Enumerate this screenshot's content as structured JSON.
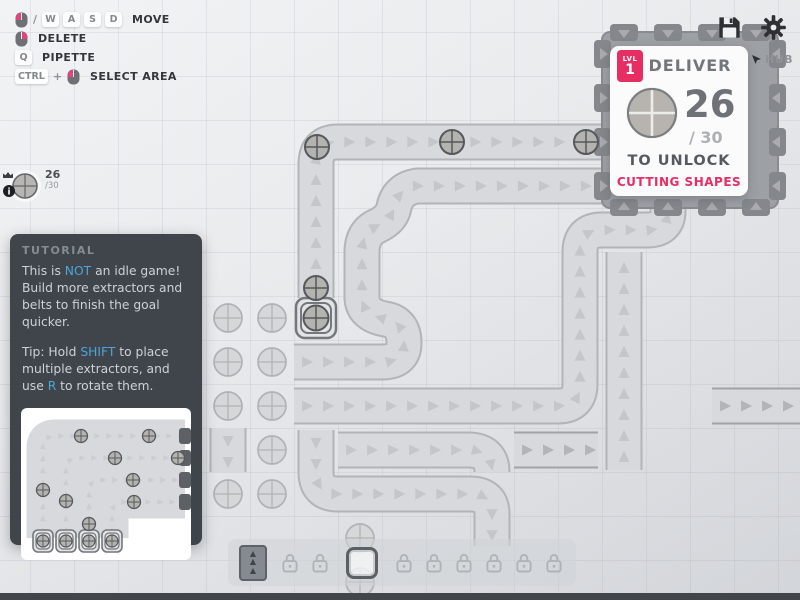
{
  "colors": {
    "accent": "#e62e63",
    "link": "#4da5d8"
  },
  "keybinds": {
    "slash": "/",
    "plus": "+",
    "row1": {
      "k1": "W",
      "k2": "A",
      "k3": "S",
      "k4": "D",
      "label": "MOVE",
      "icon": "mouse-left-click-icon"
    },
    "row2": {
      "label": "DELETE",
      "icon": "mouse-right-click-icon"
    },
    "row3": {
      "k1": "Q",
      "label": "PIPETTE"
    },
    "row4": {
      "k1": "CTRL",
      "label": "SELECT AREA",
      "icon": "mouse-left-click-icon"
    }
  },
  "pinned_goal": {
    "current": "26",
    "goal": "/30",
    "shape": "circle",
    "icons": [
      "crown-icon",
      "info-icon"
    ]
  },
  "tutorial": {
    "title": "TUTORIAL",
    "p1": [
      {
        "t": "This is "
      },
      {
        "t": "NOT",
        "hl": true
      },
      {
        "t": " an idle game! Build more extractors and belts to finish the goal quicker."
      }
    ],
    "p2": [
      {
        "t": "Tip: Hold "
      },
      {
        "t": "SHIFT",
        "hl": true
      },
      {
        "t": " to place multiple extractors, and use "
      },
      {
        "t": "R",
        "hl": true
      },
      {
        "t": " to rotate them."
      }
    ]
  },
  "hud": {
    "level_label": "LVL",
    "level": "1",
    "title": "DELIVER",
    "hub_label": "HUB",
    "current": "26",
    "goal": "/ 30",
    "unlock": "TO UNLOCK",
    "reward": "CUTTING SHAPES",
    "shape": "circle"
  },
  "top_icons": [
    "save-icon",
    "gear-icon"
  ],
  "toolbar": {
    "slots": [
      {
        "type": "belt",
        "selected": false
      },
      {
        "type": "lock",
        "selected": false
      },
      {
        "type": "lock",
        "selected": false
      },
      {
        "type": "extractor",
        "selected": true
      },
      {
        "type": "lock",
        "selected": false
      },
      {
        "type": "lock",
        "selected": false
      },
      {
        "type": "lock",
        "selected": false
      },
      {
        "type": "lock",
        "selected": false
      },
      {
        "type": "lock",
        "selected": false
      },
      {
        "type": "lock",
        "selected": false
      }
    ]
  }
}
